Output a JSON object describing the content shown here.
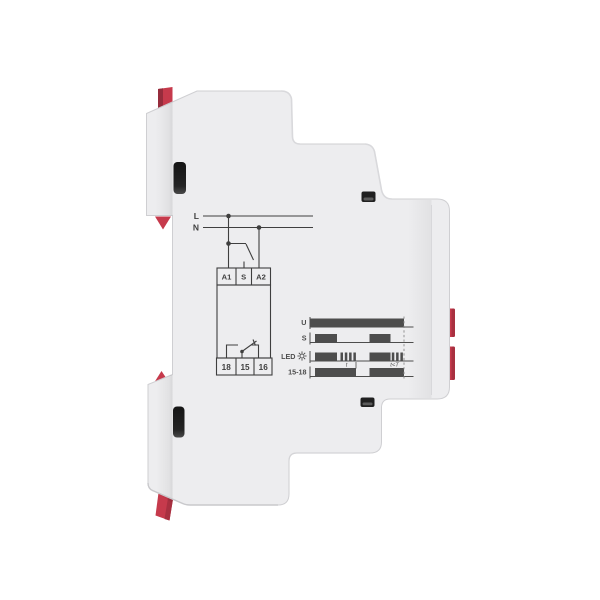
{
  "meta": {
    "background": "#ffffff",
    "body_color": "#ededef",
    "accent_red": "#c63a4c",
    "accent_red_dark": "#962c3c",
    "print_color": "#3f3f3f"
  },
  "device": {
    "kind": "din-rail-relay-side-view",
    "wiring_diagram": {
      "supply_labels": {
        "l": "L",
        "n": "N"
      },
      "top_terminals": [
        "A1",
        "S",
        "A2"
      ],
      "bottom_terminals": [
        "18",
        "15",
        "16"
      ]
    }
  },
  "chart_data": {
    "type": "timing",
    "title": "relay timing diagram",
    "axis": {
      "x0": 310,
      "x1": 413.5,
      "bar_height": 8.5,
      "dashed_end": 94
    },
    "legend_position": "left",
    "rows": [
      {
        "label": "U",
        "baseline_y": 327,
        "bars": [
          [
            0,
            94
          ]
        ]
      },
      {
        "label": "S",
        "baseline_y": 342.5,
        "bars": [
          [
            5,
            27
          ],
          [
            59.5,
            80.5
          ]
        ]
      },
      {
        "label": "LED",
        "icon": "led-glow-icon",
        "baseline_y": 361,
        "bars": [
          [
            5,
            27
          ],
          [
            30.5,
            33
          ],
          [
            34.8,
            37.3
          ],
          [
            39.1,
            41.6
          ],
          [
            43.4,
            45.9
          ],
          [
            59.5,
            80.5
          ],
          [
            81.8,
            84.3
          ],
          [
            86.1,
            88.6
          ],
          [
            90.4,
            92.9
          ]
        ]
      },
      {
        "label": "15-18",
        "baseline_y": 376.5,
        "bars": [
          [
            5,
            46
          ],
          [
            59.5,
            94
          ]
        ]
      }
    ],
    "annotations": [
      {
        "text": "t",
        "x": 36.5,
        "y": 366.5,
        "tick_x": 46
      },
      {
        "text": "t<T",
        "x": 84.5,
        "y": 366.5,
        "tick_x": null
      }
    ],
    "colors": {
      "bar": "#4d4d4d",
      "axis": "#4d4d4d",
      "dashed": "#8a8a8a"
    }
  }
}
